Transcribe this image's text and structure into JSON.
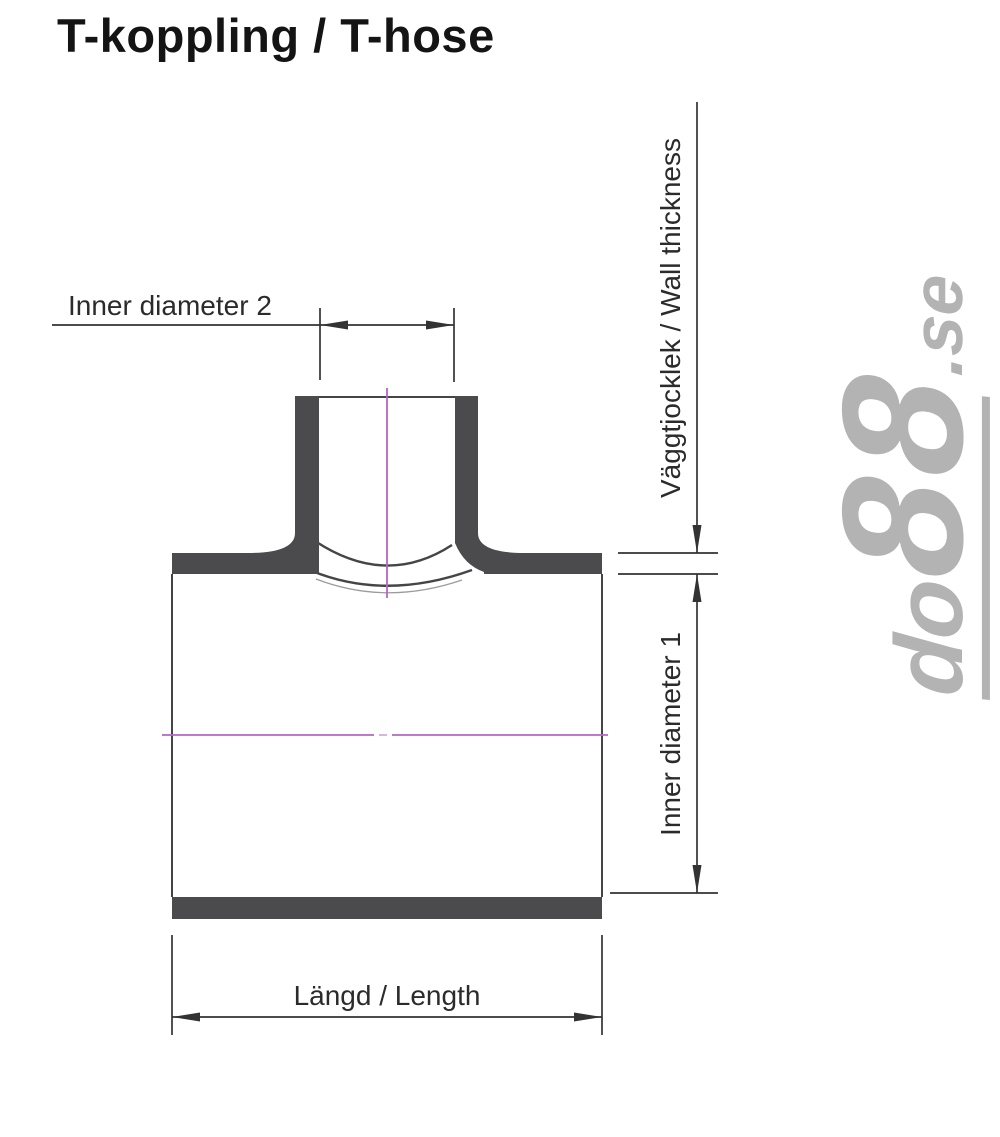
{
  "page": {
    "title": "T-koppling / T-hose"
  },
  "figure": {
    "description": "Cross-section technical drawing of a T-shaped hose coupling with dimension callouts",
    "labels": {
      "inner_diameter_2": "Inner diameter 2",
      "wall_thickness": "Väggtjocklek / Wall thickness",
      "inner_diameter_1": "Inner diameter 1",
      "length": "Längd / Length"
    }
  },
  "watermark": {
    "full": "do88.se",
    "brand_do": "do",
    "brand_88": "88",
    "tld": ".se"
  },
  "colors": {
    "background": "#ffffff",
    "title_text": "#141414",
    "label_text": "#2b2b2b",
    "wall_fill": "#4b4b4e",
    "outline": "#454548",
    "faint_line": "#9b9b9b",
    "dimension": "#333333",
    "centerline": "#b564c6",
    "watermark": "#b3b3b3"
  }
}
